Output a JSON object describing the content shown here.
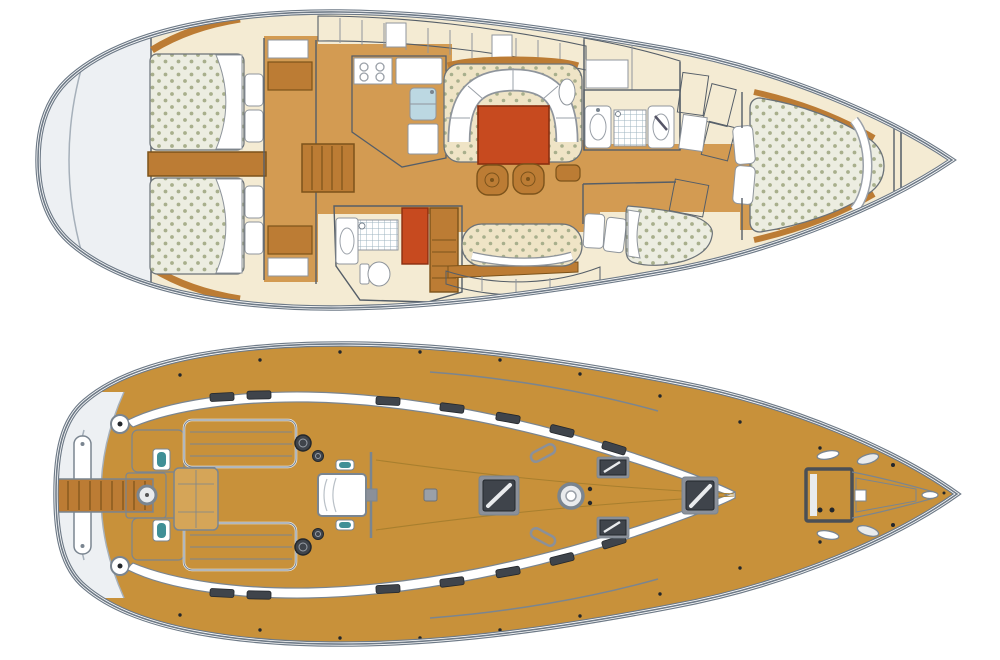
{
  "document": {
    "type": "sailing-yacht-layout-diagram",
    "description": "Two plan views of a sailing yacht, bow pointing right: interior accommodation plan (top) and teak deck plan (bottom). No text labels are present in the image.",
    "background": "#FFFFFF"
  },
  "views": {
    "interior": {
      "name": "interior-accommodation-plan",
      "position": "top",
      "rooms": [
        {
          "id": "stern-platform",
          "label": "stern transom / swim platform"
        },
        {
          "id": "aft-cabin-port",
          "label": "aft double cabin with dotted mattress, two pillows, white duvet"
        },
        {
          "id": "aft-cabin-starboard",
          "label": "aft double cabin with dotted mattress, two pillows, white duvet"
        },
        {
          "id": "engine-compartment",
          "label": "engine box between aft cabins"
        },
        {
          "id": "companionway-steps",
          "label": "companionway steps"
        },
        {
          "id": "galley",
          "label": "galley with 4-burner stove, fridge, double sink, worktop"
        },
        {
          "id": "aft-head",
          "label": "aft head with shower grid, wash basin, toilet"
        },
        {
          "id": "wet-locker",
          "label": "red-orange locker"
        },
        {
          "id": "dresser",
          "label": "wooden drawer unit"
        },
        {
          "id": "salon",
          "label": "salon with U-settee, red-orange dining table, two stools, side table and straight bench"
        },
        {
          "id": "fwd-head",
          "label": "forward head with two wash basins and shower grid"
        },
        {
          "id": "hanging-lockers",
          "label": "louvered hanging lockers"
        },
        {
          "id": "fwd-lower-cabin",
          "label": "forward lower double cabin with dotted berth and two pillows"
        },
        {
          "id": "owner-cabin",
          "label": "forward owner cabin with tapered island double berth and two pillows"
        },
        {
          "id": "anchor-locker",
          "label": "bow anchor locker triangle"
        }
      ]
    },
    "deck": {
      "name": "deck-plan",
      "position": "bottom",
      "features": [
        {
          "id": "swim-platform",
          "label": "white transom with swim ladder"
        },
        {
          "id": "passerelle",
          "label": "wooden gangplank extending aft"
        },
        {
          "id": "stern-cleats",
          "label": "round mooring cleats"
        },
        {
          "id": "helm-pedestal",
          "label": "helm / compass pedestal"
        },
        {
          "id": "lazarette-lids",
          "label": "aft deck locker lids"
        },
        {
          "id": "cockpit-benches",
          "label": "slatted cockpit benches"
        },
        {
          "id": "cockpit-table",
          "label": "folding cockpit table"
        },
        {
          "id": "winches",
          "label": "primary and secondary winches"
        },
        {
          "id": "companionway-hatch",
          "label": "white companionway sliding hatch"
        },
        {
          "id": "mainsheet-traveler",
          "label": "mainsheet traveler track"
        },
        {
          "id": "coachroof-band",
          "label": "white coachroof side band with dark windows"
        },
        {
          "id": "deck-hatches",
          "label": "dark flush deck hatches with glazing glint"
        },
        {
          "id": "mast-step",
          "label": "mast ring"
        },
        {
          "id": "dorade-handles",
          "label": "angled grab handles near mast"
        },
        {
          "id": "anchor-windlass-hatch",
          "label": "square anchor windlass hatch"
        },
        {
          "id": "bow-fittings",
          "label": "bow cleats, roller and stem fitting"
        },
        {
          "id": "genoa-tracks",
          "label": "side deck genoa tracks"
        },
        {
          "id": "stanchions",
          "label": "lifeline stanchion bases along rail"
        }
      ]
    }
  },
  "colors": {
    "outline": "#6E7A87",
    "outlineSoft": "#A6B0BA",
    "wall": "#555E68",
    "cream": "#F4EBD3",
    "cream2": "#EFE4C6",
    "white": "#FFFFFF",
    "offWhite": "#EDF0F3",
    "wood": "#D39B52",
    "woodDark": "#BC7C34",
    "woodEdge": "#7C531B",
    "mattress": "#ECEDE1",
    "dot": "#A8AF8C",
    "red": "#C74A1F",
    "redEdge": "#8A2F10",
    "blue": "#D8E8EE",
    "blueMid": "#BCD8E2",
    "gridline": "#9FB4C0",
    "teak": "#C8913A",
    "teakLight": "#D5A558",
    "hatch": "#3F444B",
    "hatchDark": "#23272C",
    "hatchFrame": "#8B9099",
    "deckline": "#7A8590",
    "teal": "#3F8F96",
    "stripe": "#B9AD8B"
  }
}
